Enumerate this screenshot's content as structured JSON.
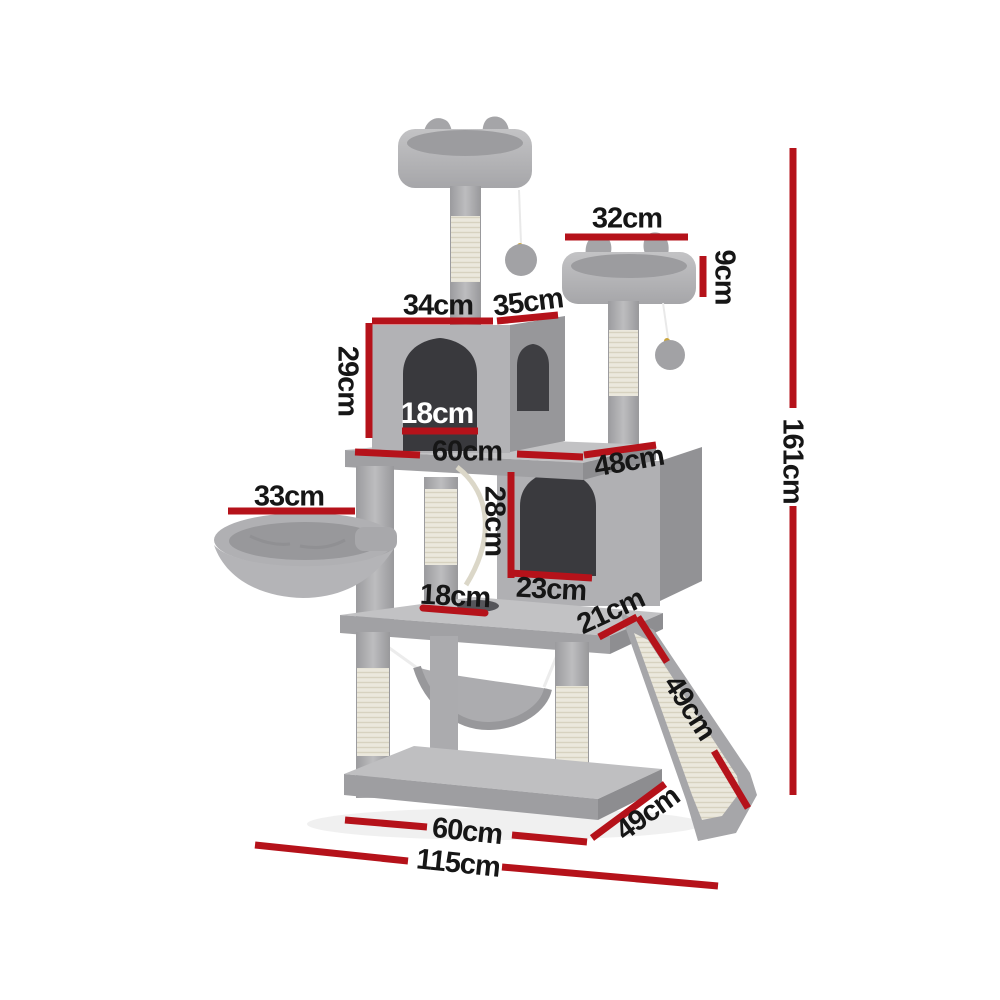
{
  "diagram": {
    "subject": "Cat tree tower dimension diagram with perches, condos, basket, hammock, scratching posts and ramp",
    "colors": {
      "background": "#ffffff",
      "dimension_line": "#b5121a",
      "label_text": "#161616",
      "label_text_on_dark": "#ffffff",
      "plush_grey": "#b3b3b6",
      "sisal": "#ebe8dd"
    },
    "dims": {
      "d32": "32cm",
      "d9": "9cm",
      "d34": "34cm",
      "d35": "35cm",
      "d29": "29cm",
      "d18_door": "18cm",
      "d60_mid": "60cm",
      "d48": "48cm",
      "d33": "33cm",
      "d28": "28cm",
      "d23": "23cm",
      "d18_hole": "18cm",
      "d21": "21cm",
      "d49_ramp": "49cm",
      "d49_base": "49cm",
      "d60_base": "60cm",
      "d115": "115cm",
      "d161": "161cm"
    }
  }
}
